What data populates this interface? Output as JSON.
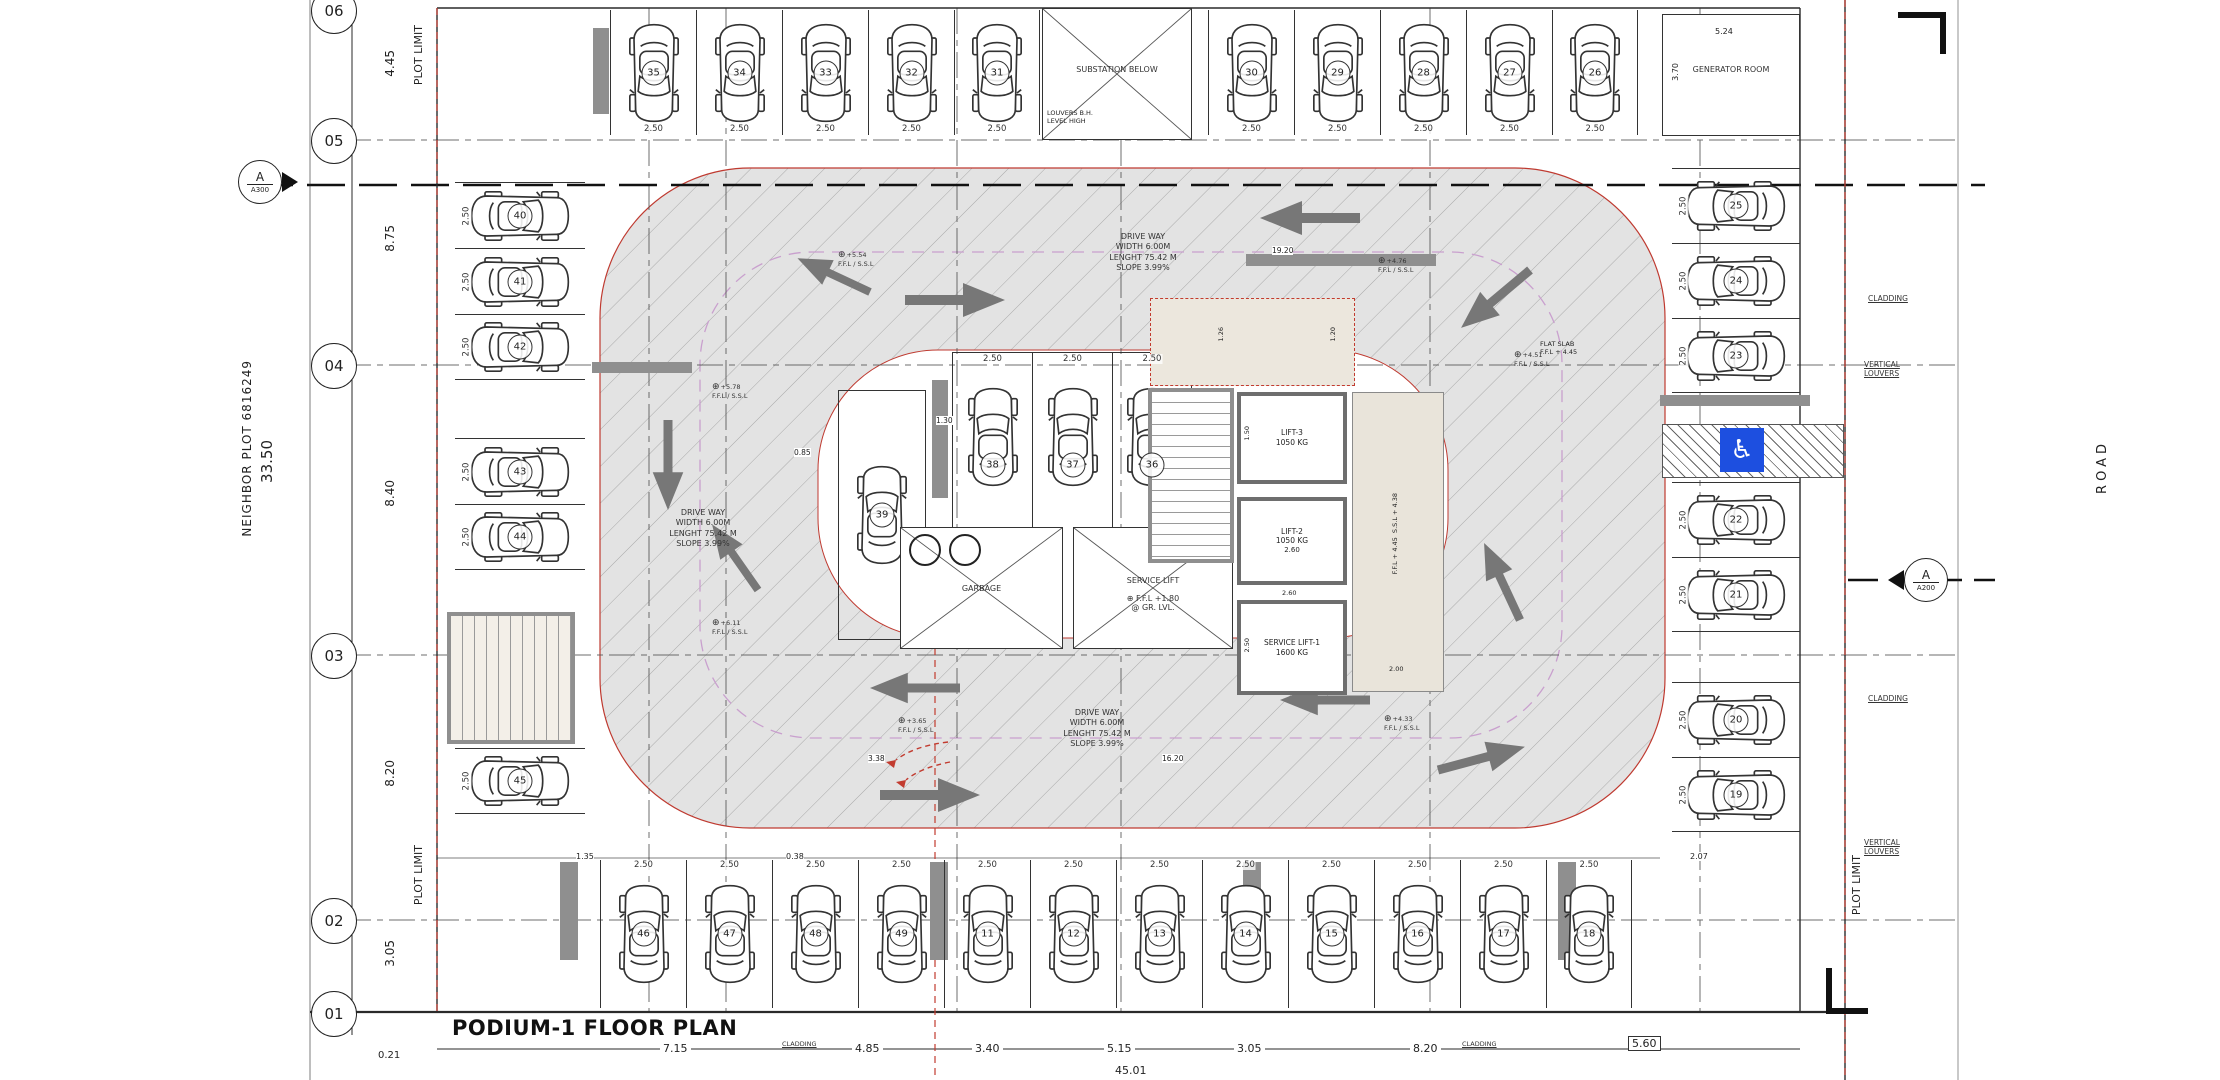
{
  "sheet": {
    "title": "PODIUM-1 FLOOR PLAN"
  },
  "icons": {
    "level_target": "⊕",
    "accessible": "♿"
  },
  "boundary": {
    "plot_limit": "PLOT LIMIT",
    "neighbor_plot": "NEIGHBOR PLOT 6816249",
    "road": "ROAD"
  },
  "grid": {
    "bubbles": [
      "06",
      "05",
      "04",
      "03",
      "02",
      "01"
    ],
    "dims": {
      "d_06_05": "4.45",
      "d_05_04": "8.75",
      "d_04_03": "8.40",
      "d_03_02": "8.20",
      "d_02_01": "3.05",
      "total": "33.50",
      "offset": "0.21"
    }
  },
  "section_markers": {
    "left": {
      "letter": "A",
      "sheet": "A300"
    },
    "right": {
      "letter": "A",
      "sheet": "A200"
    }
  },
  "rooms": {
    "substation": "SUBSTATION BELOW",
    "substation_note_1": "LOUVERS B.H.",
    "substation_note_2": "LEVEL HIGH",
    "generator": "GENERATOR ROOM",
    "generator_w": "5.24",
    "generator_h": "3.70",
    "garbage": "GARBAGE",
    "service_room": "SERVICE LIFT",
    "service_room_l1": "F.F.L +1.80",
    "service_room_l2": "@ GR. LVL.",
    "stair": "STAIR-01",
    "stair_dim": "2.65",
    "vestibule_d1": "1.26",
    "vestibule_d2": "1.20",
    "lifts": [
      {
        "name": "LIFT-3",
        "capacity": "1050 KG",
        "w": "1.50"
      },
      {
        "name": "LIFT-2",
        "capacity": "1050 KG",
        "w": "2.60"
      },
      {
        "name": "SERVICE LIFT-1",
        "capacity": "1600 KG",
        "w": "2.60"
      }
    ],
    "service_lift_d": "2.50",
    "lobby_l1": "F.F.L + 4.45",
    "lobby_l2": "S.S.L + 4.38",
    "lobby_d": "2.00",
    "flat_slab_l1": "FLAT SLAB",
    "flat_slab_l2": "F.F.L + 4.45"
  },
  "driveway_note": {
    "l1": "DRIVE WAY",
    "l2": "WIDTH 6.00M",
    "l3": "LENGHT 75.42 M",
    "l4": "SLOPE 3.99%"
  },
  "levels": {
    "label": "F.F.L / S.S.L",
    "tl": "+5.54",
    "tr": "+4.76",
    "lc": "+5.78",
    "rc": "+4.51",
    "bl": "+6.11",
    "bc": "+3.65",
    "br": "+4.33"
  },
  "parking": {
    "stall_width": "2.50",
    "top_a": [
      "35",
      "34",
      "33",
      "32",
      "31"
    ],
    "top_b": [
      "30",
      "29",
      "28",
      "27",
      "26"
    ],
    "left_a": [
      "40",
      "41",
      "42"
    ],
    "left_b": [
      "43",
      "44"
    ],
    "left_c": [
      "45"
    ],
    "right_a": [
      "25",
      "24",
      "23"
    ],
    "right_b": [
      "22",
      "21"
    ],
    "right_c": [
      "20",
      "19"
    ],
    "center_a": [
      "39"
    ],
    "center_b": [
      "38",
      "37",
      "36"
    ],
    "bottom": [
      "46",
      "47",
      "48",
      "49",
      "11",
      "12",
      "13",
      "14",
      "15",
      "16",
      "17",
      "18"
    ]
  },
  "dims": {
    "drive_top": "19.20",
    "drive_bottom": "16.20",
    "d338": "3.38",
    "d085": "0.85",
    "d130": "1.30",
    "d135": "1.35",
    "d038": "0.38",
    "d207": "2.07"
  },
  "bottom_dims": {
    "a": "7.15",
    "b": "4.85",
    "c": "3.40",
    "d": "5.15",
    "e": "3.05",
    "f": "8.20",
    "boxed": "5.60",
    "total": "45.01"
  },
  "facade": {
    "cladding": "CLADDING",
    "louvers_l1": "VERTICAL",
    "louvers_l2": "LOUVERS"
  }
}
